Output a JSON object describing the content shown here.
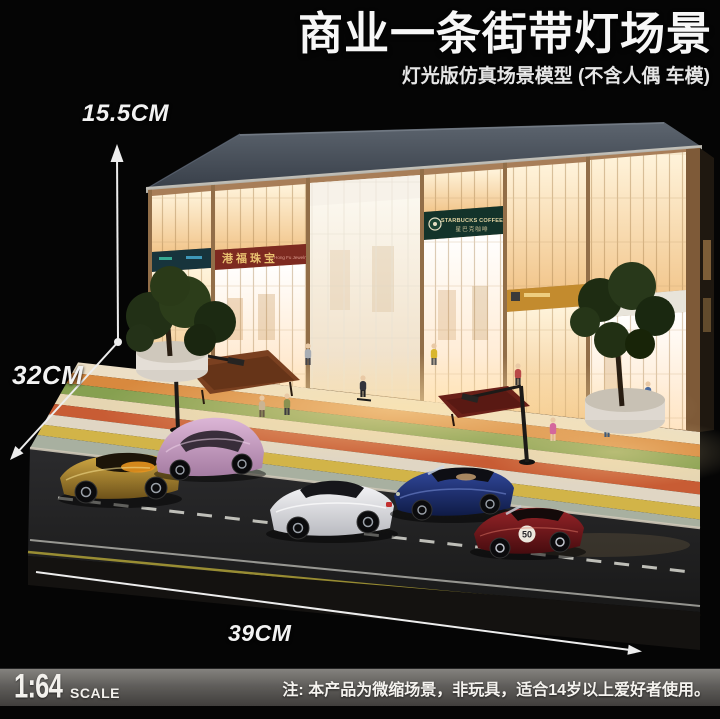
{
  "header": {
    "title": "商业一条街带灯场景",
    "subtitle": "灯光版仿真场景模型 (不含人偶 车模)"
  },
  "dimensions": {
    "height": "15.5CM",
    "depth": "32CM",
    "width": "39CM"
  },
  "scene": {
    "signs": {
      "starbucks_en": "STARBUCKS COFFEE",
      "starbucks_cn": "星巴克咖啡",
      "jewelry_cn": "港福珠宝",
      "jewelry_en": "Hong Fu Jewelry"
    },
    "race_number": "50",
    "cars": [
      "gold-convertible",
      "pink-beetle",
      "white-sports-car",
      "blue-roadster",
      "dark-red-roadster"
    ]
  },
  "footer": {
    "scale_value": "1:64",
    "scale_unit": "SCALE",
    "note": "注: 本产品为微缩场景，非玩具，适合14岁以上爱好者使用。"
  },
  "colors": {
    "background": "#050505",
    "title_text": "#f7f7f7",
    "roof_slate": "#49515c",
    "facade_tan": "#a87e58",
    "window_glow": "#ffe9c2",
    "starbucks_green": "#13332a",
    "jewelry_maroon": "#7d2a20",
    "footer_bar": "#605e5b"
  }
}
